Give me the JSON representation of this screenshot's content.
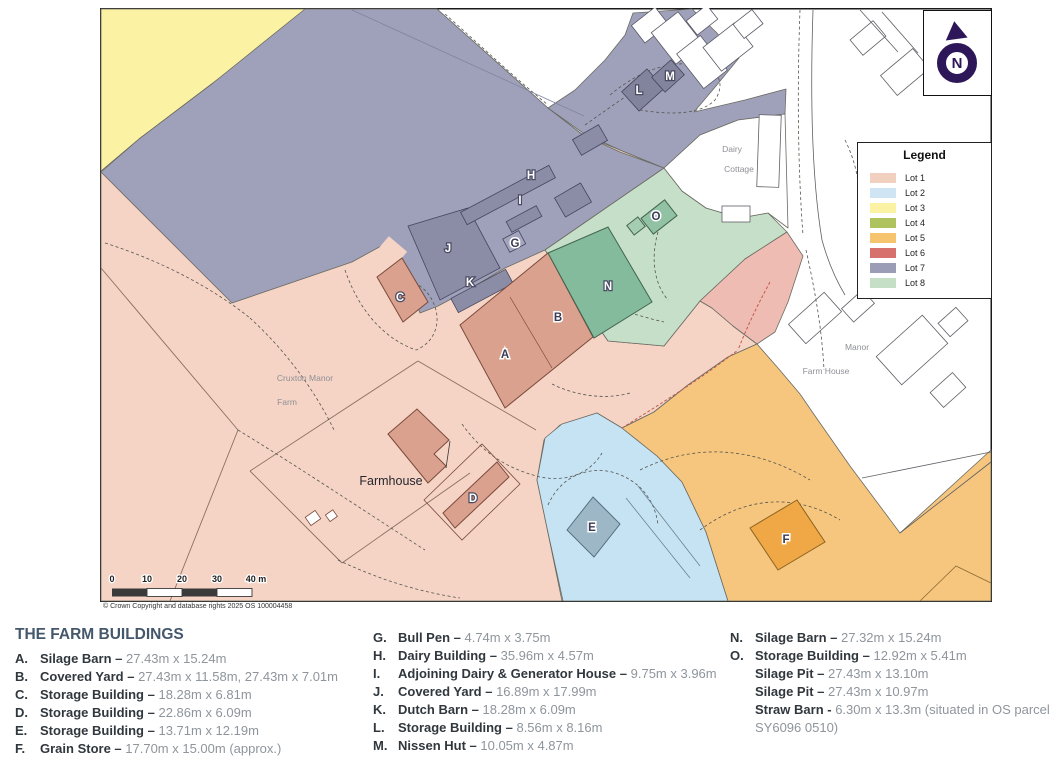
{
  "map": {
    "copyright": "© Crown Copyright and database rights 2025 OS 100004458",
    "north_label": "N",
    "scalebar": {
      "labels": [
        {
          "t": "0",
          "x": 112
        },
        {
          "t": "10",
          "x": 147
        },
        {
          "t": "20",
          "x": 182
        },
        {
          "t": "30",
          "x": 217
        },
        {
          "t": "40 m",
          "x": 256
        }
      ]
    },
    "legend": {
      "title": "Legend",
      "items": [
        {
          "label": "Lot 1",
          "color": "#f2d0bf"
        },
        {
          "label": "Lot 2",
          "color": "#cfe5f4"
        },
        {
          "label": "Lot 3",
          "color": "#fbf3a3"
        },
        {
          "label": "Lot 4",
          "color": "#aec25e"
        },
        {
          "label": "Lot 5",
          "color": "#f6c36e"
        },
        {
          "label": "Lot 6",
          "color": "#d7716e"
        },
        {
          "label": "Lot 7",
          "color": "#9b9db7"
        },
        {
          "label": "Lot 8",
          "color": "#c5dfc6"
        }
      ]
    },
    "place_labels": [
      {
        "text": "Cruxton Manor",
        "x": 305,
        "y": 381,
        "cls": "small"
      },
      {
        "text": "Farm",
        "x": 287,
        "y": 405,
        "cls": "small"
      },
      {
        "text": "Farmhouse",
        "x": 391,
        "y": 485,
        "cls": "big"
      },
      {
        "text": "Dairy",
        "x": 732,
        "y": 152,
        "cls": "small"
      },
      {
        "text": "Cottage",
        "x": 739,
        "y": 172,
        "cls": "small"
      },
      {
        "text": "Manor",
        "x": 857,
        "y": 350,
        "cls": "small"
      },
      {
        "text": "Farm House",
        "x": 826,
        "y": 374,
        "cls": "small"
      }
    ],
    "building_markers": [
      {
        "letter": "A",
        "x": 505,
        "y": 358,
        "style": "dark"
      },
      {
        "letter": "B",
        "x": 558,
        "y": 321,
        "style": "dark"
      },
      {
        "letter": "C",
        "x": 400,
        "y": 301,
        "style": "light"
      },
      {
        "letter": "D",
        "x": 473,
        "y": 502,
        "style": "light"
      },
      {
        "letter": "E",
        "x": 592,
        "y": 531,
        "style": "dark"
      },
      {
        "letter": "F",
        "x": 786,
        "y": 543,
        "style": "dark"
      },
      {
        "letter": "G",
        "x": 515,
        "y": 247,
        "style": "dark"
      },
      {
        "letter": "H",
        "x": 531,
        "y": 179,
        "style": "light"
      },
      {
        "letter": "I",
        "x": 520,
        "y": 204,
        "style": "light"
      },
      {
        "letter": "J",
        "x": 448,
        "y": 252,
        "style": "light"
      },
      {
        "letter": "K",
        "x": 470,
        "y": 286,
        "style": "light"
      },
      {
        "letter": "L",
        "x": 639,
        "y": 94,
        "style": "light"
      },
      {
        "letter": "M",
        "x": 670,
        "y": 80,
        "style": "light"
      },
      {
        "letter": "N",
        "x": 608,
        "y": 290,
        "style": "light"
      },
      {
        "letter": "O",
        "x": 656,
        "y": 220,
        "style": "dark"
      }
    ]
  },
  "listing": {
    "title": "THE FARM BUILDINGS",
    "columns": [
      {
        "entries": [
          {
            "key": "A.",
            "name": "Silage Barn",
            "sep": "–",
            "dims": "27.43m x 15.24m"
          },
          {
            "key": "B.",
            "name": "Covered Yard",
            "sep": "–",
            "dims": "27.43m x 11.58m, 27.43m x 7.01m"
          },
          {
            "key": "C.",
            "name": "Storage Building",
            "sep": "–",
            "dims": "18.28m x 6.81m"
          },
          {
            "key": "D.",
            "name": "Storage Building",
            "sep": "–",
            "dims": "22.86m x 6.09m"
          },
          {
            "key": "E.",
            "name": "Storage Building",
            "sep": "–",
            "dims": "13.71m x 12.19m"
          },
          {
            "key": "F.",
            "name": "Grain Store",
            "sep": "–",
            "dims": "17.70m x 15.00m (approx.)"
          }
        ]
      },
      {
        "entries": [
          {
            "key": "G.",
            "name": "Bull Pen",
            "sep": "–",
            "dims": "4.74m x 3.75m"
          },
          {
            "key": "H.",
            "name": "Dairy Building",
            "sep": "–",
            "dims": "35.96m x 4.57m"
          },
          {
            "key": "I.",
            "name": "Adjoining Dairy & Generator House",
            "sep": "–",
            "dims": "9.75m x 3.96m"
          },
          {
            "key": "J.",
            "name": "Covered Yard",
            "sep": "–",
            "dims": "16.89m x 17.99m"
          },
          {
            "key": "K.",
            "name": "Dutch Barn",
            "sep": "–",
            "dims": "18.28m x 6.09m"
          },
          {
            "key": "L.",
            "name": "Storage Building",
            "sep": "–",
            "dims": "8.56m x 8.16m"
          },
          {
            "key": "M.",
            "name": "Nissen Hut",
            "sep": "–",
            "dims": "10.05m x 4.87m"
          }
        ]
      },
      {
        "entries": [
          {
            "key": "N.",
            "name": "Silage Barn",
            "sep": "–",
            "dims": "27.32m x 15.24m"
          },
          {
            "key": "O.",
            "name": "Storage Building",
            "sep": "–",
            "dims": "12.92m x 5.41m"
          },
          {
            "key": "",
            "name": "Silage Pit",
            "sep": "–",
            "dims": "27.43m x 13.10m"
          },
          {
            "key": "",
            "name": "Silage Pit",
            "sep": "–",
            "dims": "27.43m x 10.97m"
          },
          {
            "key": "",
            "name": "Straw Barn",
            "sep": "-",
            "dims": "6.30m x 13.3m (situated in OS parcel"
          },
          {
            "key": "",
            "name": "",
            "sep": "",
            "dims": "SY6096 0510)"
          }
        ]
      }
    ]
  }
}
